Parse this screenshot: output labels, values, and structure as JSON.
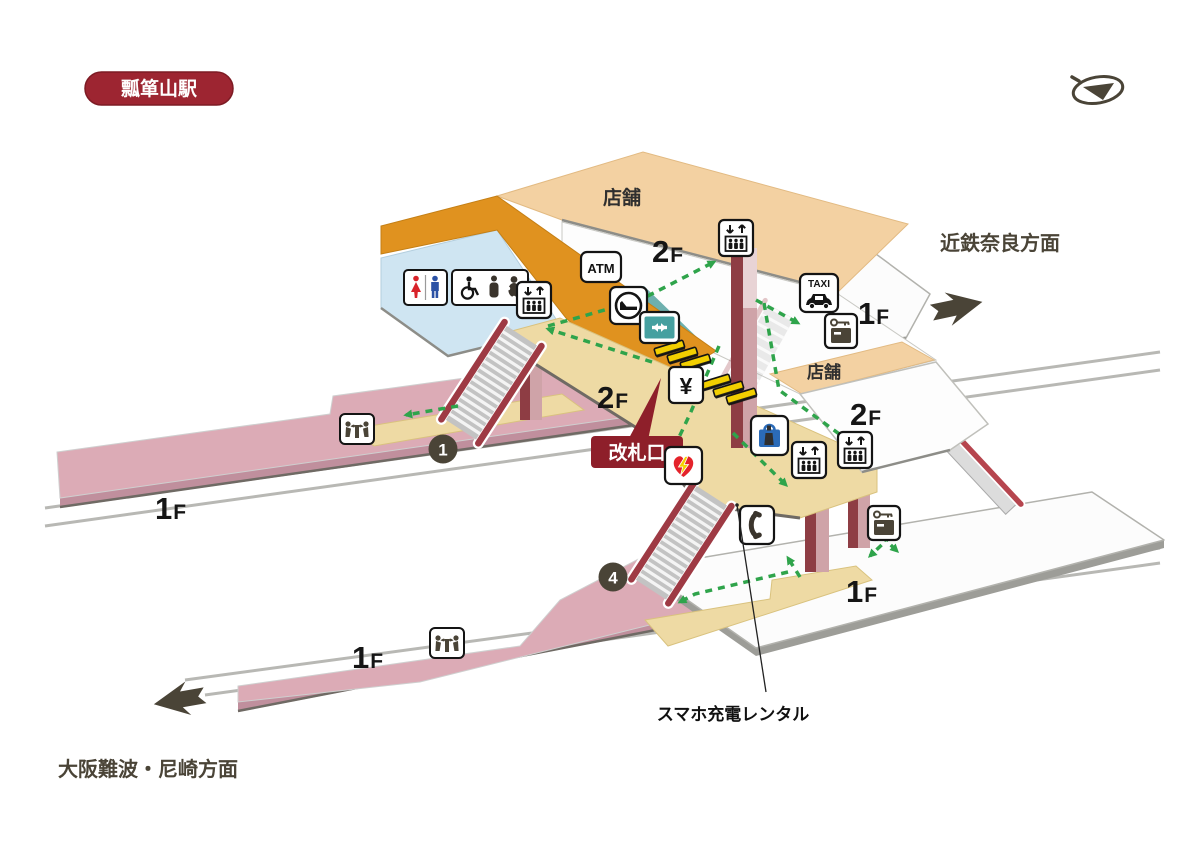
{
  "station": {
    "name": "瓢箪山駅"
  },
  "directions": {
    "nara": "近鉄奈良方面",
    "namba": "大阪難波・尼崎方面"
  },
  "annotations": {
    "smartphone_rental": "スマホ充電レンタル",
    "ticket_gate": "改札口"
  },
  "areas": {
    "shop_top": "店舗",
    "shop_right": "店舗"
  },
  "floor_labels": {
    "f2_big": "2",
    "f1_big": "1",
    "suffix": "F"
  },
  "platforms": {
    "p1": "1",
    "p4": "4"
  },
  "icon_text": {
    "atm": "ATM",
    "taxi": "TAXI",
    "ticket_machine": "¥"
  },
  "icons_present": [
    "compass-icon",
    "toilet-icon",
    "accessible-toilet-icon",
    "elevator-icon",
    "atm-icon",
    "waiting-room-icon",
    "passage-double-arrow-icon",
    "taxi-icon",
    "coin-locker-icon",
    "ticket-machine-icon",
    "aed-icon",
    "kiosk-bag-icon",
    "public-phone-icon",
    "drinking-fountain-icon",
    "stairs",
    "escalator",
    "ticket-gates"
  ],
  "colors": {
    "badge_red": "#9d2531",
    "gate_red": "#8e1f2a",
    "peach": "#f3d1a2",
    "orange": "#e0921f",
    "light_blue": "#cfe5f2",
    "teal_area": "#6db0ae",
    "teal_icon": "#46a0a0",
    "concourse_tan": "#eedaa4",
    "platform_pink": "#dcabb6",
    "path_green": "#2fa44b",
    "pillar_maroon": "#8e3d44",
    "direction_olive": "#4a4437",
    "gate_yellow": "#f2cf00"
  }
}
